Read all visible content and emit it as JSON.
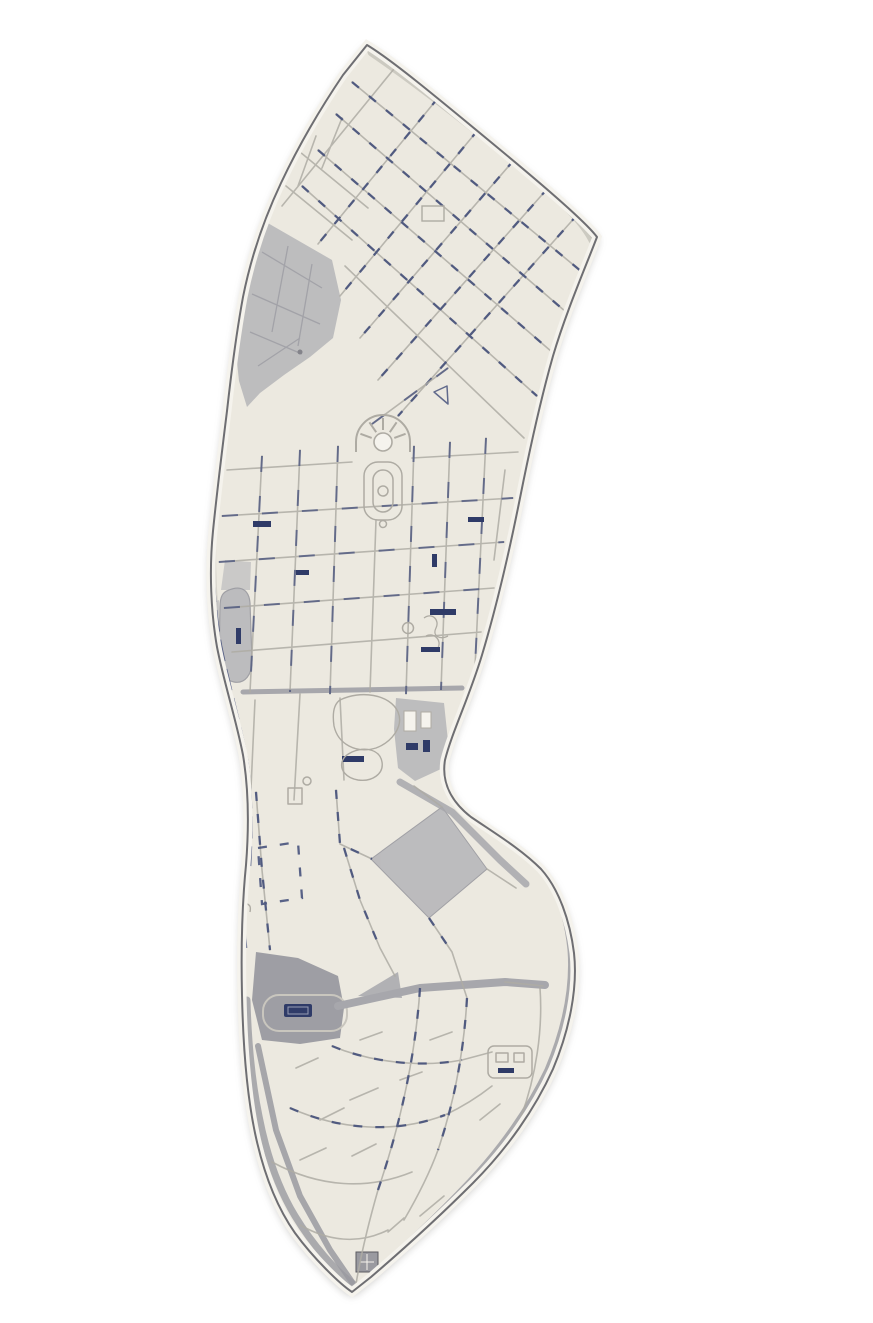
{
  "window": {
    "width": 873,
    "height": 1323
  },
  "map": {
    "type": "photographed-city-plan",
    "has_text_labels": false,
    "palette": {
      "bg": "#ffffff",
      "paper": "#ece9e0",
      "paper-light": "#f5f3ed",
      "contour": "#5b5b61",
      "line": "#aeaba3",
      "line-soft": "#c9c6be",
      "navy": "#3e4a77",
      "navy-dark": "#2f3b68",
      "zone": "#b8b8bb",
      "zone-dark": "#9a9aa0",
      "road": "#a7a7ac",
      "shadow": "rgba(94,92,88,0.40)"
    },
    "features": [
      {
        "id": "district-boundary",
        "kind": "outline"
      },
      {
        "id": "northeast-boundary-road",
        "kind": "road"
      },
      {
        "id": "citadel-gray-zone",
        "kind": "gray-area"
      },
      {
        "id": "left-oval-park",
        "kind": "gray-area"
      },
      {
        "id": "central-plaza-rotunda",
        "kind": "landmark"
      },
      {
        "id": "garden-promenade",
        "kind": "landmark"
      },
      {
        "id": "main-cross-road",
        "kind": "road"
      },
      {
        "id": "waist-building-complex",
        "kind": "gray-area"
      },
      {
        "id": "gray-diamond-block",
        "kind": "gray-area"
      },
      {
        "id": "railway-station-zone",
        "kind": "gray-area"
      },
      {
        "id": "station-avenue",
        "kind": "road"
      },
      {
        "id": "southeast-ring-road",
        "kind": "road"
      },
      {
        "id": "left-edge-railway",
        "kind": "railway"
      },
      {
        "id": "street-grid-north",
        "kind": "streets"
      },
      {
        "id": "street-grid-center",
        "kind": "streets"
      },
      {
        "id": "street-network-south",
        "kind": "streets"
      },
      {
        "id": "small-landmarks",
        "kind": "landmarks"
      }
    ]
  }
}
